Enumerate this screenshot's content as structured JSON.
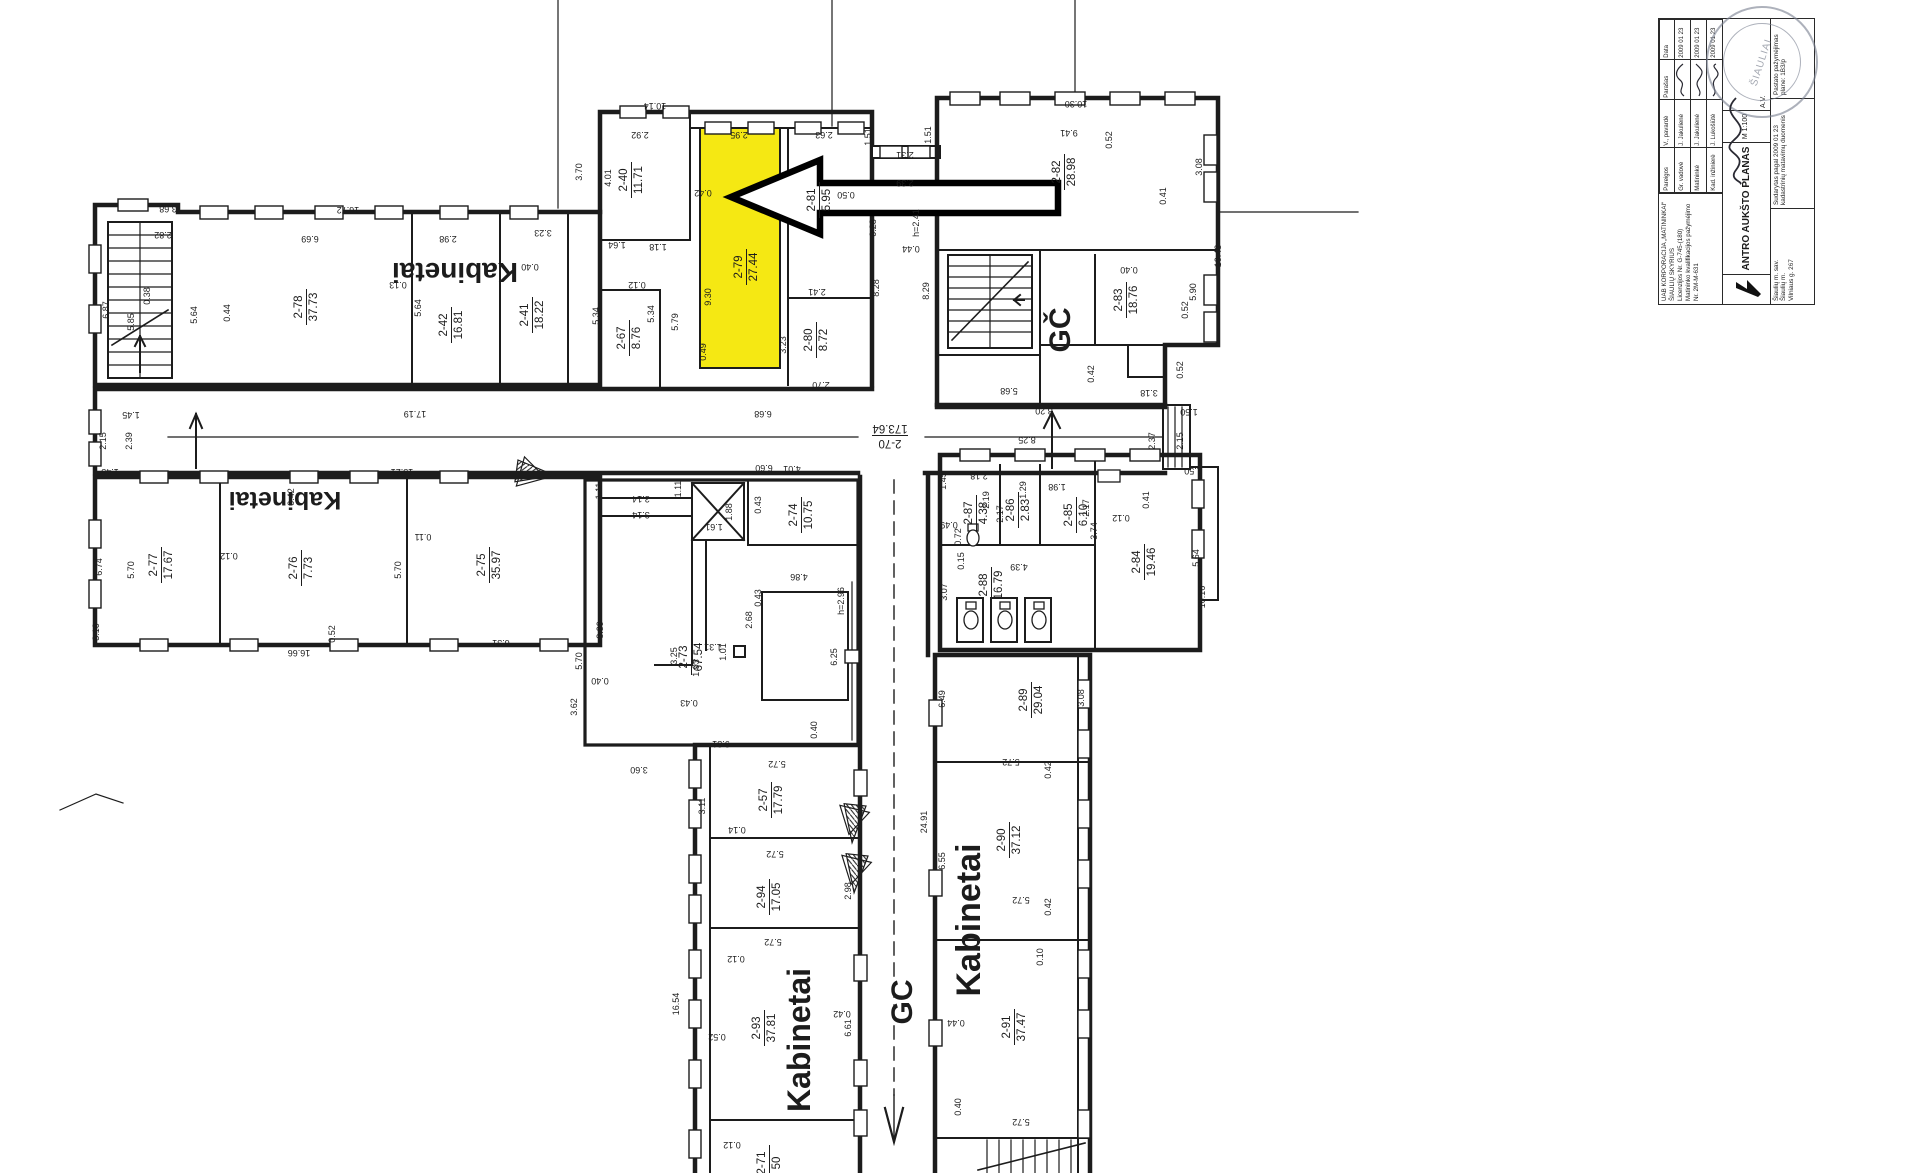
{
  "colors": {
    "highlight": "#f5e813",
    "line": "#1c1c1c",
    "stamp": "#7b8292"
  },
  "plan": {
    "rooms": [
      {
        "id": "2-78",
        "area": "37.73",
        "x": 305,
        "y": 307,
        "rot": -90
      },
      {
        "id": "2-42",
        "area": "16.81",
        "x": 450,
        "y": 325,
        "rot": -90
      },
      {
        "id": "2-41",
        "area": "18.22",
        "x": 531,
        "y": 315,
        "rot": -90
      },
      {
        "id": "2-40",
        "area": "11.71",
        "x": 630,
        "y": 180,
        "rot": -90
      },
      {
        "id": "2-67",
        "area": "8.76",
        "x": 628,
        "y": 338,
        "rot": -90
      },
      {
        "id": "2-79",
        "area": "27.44",
        "x": 745,
        "y": 267,
        "rot": -90
      },
      {
        "id": "2-81",
        "area": "5.95",
        "x": 818,
        "y": 200,
        "rot": -90
      },
      {
        "id": "2-80",
        "area": "8.72",
        "x": 815,
        "y": 340,
        "rot": -90
      },
      {
        "id": "2-82",
        "area": "28.98",
        "x": 1063,
        "y": 172,
        "rot": -90
      },
      {
        "id": "2-83",
        "area": "18.76",
        "x": 1125,
        "y": 300,
        "rot": -90
      },
      {
        "id": "2-70",
        "area": "173.64",
        "x": 890,
        "y": 437,
        "rot": 180
      },
      {
        "id": "2-77",
        "area": "17.67",
        "x": 160,
        "y": 565,
        "rot": -90
      },
      {
        "id": "2-76",
        "area": "7.73",
        "x": 300,
        "y": 568,
        "rot": -90
      },
      {
        "id": "2-75",
        "area": "35.97",
        "x": 488,
        "y": 565,
        "rot": -90
      },
      {
        "id": "2-73",
        "area": "67.54",
        "x": 690,
        "y": 657,
        "rot": -90
      },
      {
        "id": "2-74",
        "area": "10.75",
        "x": 800,
        "y": 515,
        "rot": -90
      },
      {
        "id": "2-87",
        "area": "4.38",
        "x": 975,
        "y": 513,
        "rot": -90
      },
      {
        "id": "2-86",
        "area": "2.83",
        "x": 1017,
        "y": 510,
        "rot": -90
      },
      {
        "id": "2-85",
        "area": "6.10",
        "x": 1075,
        "y": 515,
        "rot": -90
      },
      {
        "id": "2-88",
        "area": "16.79",
        "x": 990,
        "y": 585,
        "rot": -90
      },
      {
        "id": "2-84",
        "area": "19.46",
        "x": 1143,
        "y": 562,
        "rot": -90
      },
      {
        "id": "2-57",
        "area": "17.79",
        "x": 770,
        "y": 800,
        "rot": -90
      },
      {
        "id": "2-94",
        "area": "17.05",
        "x": 768,
        "y": 897,
        "rot": -90
      },
      {
        "id": "2-93",
        "area": "37.81",
        "x": 763,
        "y": 1028,
        "rot": -90
      },
      {
        "id": "2-89",
        "area": "29.04",
        "x": 1030,
        "y": 700,
        "rot": -90
      },
      {
        "id": "2-90",
        "area": "37.12",
        "x": 1008,
        "y": 840,
        "rot": -90
      },
      {
        "id": "2-91",
        "area": "37.47",
        "x": 1013,
        "y": 1027,
        "rot": -90
      },
      {
        "id": "2-71",
        "area": "50",
        "x": 768,
        "y": 1163,
        "rot": -90
      }
    ],
    "big_labels": [
      {
        "t": "Kabinetai",
        "x": 455,
        "y": 263,
        "rot": 180,
        "s": 28
      },
      {
        "t": "Kabinetai",
        "x": 285,
        "y": 492,
        "rot": 180,
        "s": 25
      },
      {
        "t": "Kabinetai",
        "x": 810,
        "y": 1040,
        "rot": -90,
        "s": 32
      },
      {
        "t": "Kabinetai",
        "x": 980,
        "y": 920,
        "rot": -90,
        "s": 34
      },
      {
        "t": "GČ",
        "x": 1070,
        "y": 330,
        "rot": -90,
        "s": 30
      },
      {
        "t": "GC",
        "x": 912,
        "y": 1002,
        "rot": -90,
        "s": 30
      }
    ],
    "dims": [
      {
        "t": "3.68",
        "x": 168,
        "y": 206,
        "r": 180
      },
      {
        "t": "2.82",
        "x": 163,
        "y": 232,
        "r": 180
      },
      {
        "t": "16.72",
        "x": 348,
        "y": 207,
        "r": 180
      },
      {
        "t": "6.69",
        "x": 310,
        "y": 236,
        "r": 180
      },
      {
        "t": "2.98",
        "x": 448,
        "y": 236,
        "r": 180
      },
      {
        "t": "0.13",
        "x": 398,
        "y": 282,
        "r": 180
      },
      {
        "t": "6.87",
        "x": 109,
        "y": 310,
        "r": -90
      },
      {
        "t": "5.85",
        "x": 134,
        "y": 322,
        "r": -90
      },
      {
        "t": "5.64",
        "x": 197,
        "y": 315,
        "r": -90
      },
      {
        "t": "0.44",
        "x": 230,
        "y": 313,
        "r": -90
      },
      {
        "t": "5.64",
        "x": 421,
        "y": 308,
        "r": -90
      },
      {
        "t": "3.23",
        "x": 543,
        "y": 230,
        "r": 180
      },
      {
        "t": "0.38",
        "x": 150,
        "y": 296,
        "r": -90
      },
      {
        "t": "1.45",
        "x": 131,
        "y": 412,
        "r": 180
      },
      {
        "t": "2.15",
        "x": 106,
        "y": 441,
        "r": -90
      },
      {
        "t": "2.39",
        "x": 132,
        "y": 441,
        "r": -90
      },
      {
        "t": "1.45",
        "x": 110,
        "y": 469,
        "r": 180
      },
      {
        "t": "17.19",
        "x": 415,
        "y": 411,
        "r": 180
      },
      {
        "t": "15.21",
        "x": 402,
        "y": 469,
        "r": 180
      },
      {
        "t": "10.14",
        "x": 655,
        "y": 103,
        "r": 180
      },
      {
        "t": "3.70",
        "x": 582,
        "y": 172,
        "r": -90
      },
      {
        "t": "2.92",
        "x": 640,
        "y": 132,
        "r": 180
      },
      {
        "t": "4.01",
        "x": 611,
        "y": 178,
        "r": -90
      },
      {
        "t": "0.40",
        "x": 530,
        "y": 264,
        "r": 180
      },
      {
        "t": "1.64",
        "x": 617,
        "y": 242,
        "r": 180
      },
      {
        "t": "1.18",
        "x": 658,
        "y": 244,
        "r": 180
      },
      {
        "t": "0.12",
        "x": 637,
        "y": 282,
        "r": 180
      },
      {
        "t": "5.34",
        "x": 599,
        "y": 316,
        "r": -90
      },
      {
        "t": "5.34",
        "x": 654,
        "y": 314,
        "r": -90
      },
      {
        "t": "5.79",
        "x": 678,
        "y": 322,
        "r": -90
      },
      {
        "t": "2.95",
        "x": 739,
        "y": 132,
        "r": 180
      },
      {
        "t": "0.42",
        "x": 703,
        "y": 190,
        "r": 180
      },
      {
        "t": "9.30",
        "x": 711,
        "y": 297,
        "r": -90
      },
      {
        "t": "0.49",
        "x": 706,
        "y": 352,
        "r": -90
      },
      {
        "t": "2.63",
        "x": 824,
        "y": 132,
        "r": 180
      },
      {
        "t": "0.50",
        "x": 846,
        "y": 192,
        "r": 180
      },
      {
        "t": "2.41",
        "x": 817,
        "y": 289,
        "r": 180
      },
      {
        "t": "3.23",
        "x": 786,
        "y": 345,
        "r": -90
      },
      {
        "t": "2.70",
        "x": 821,
        "y": 382,
        "r": 180
      },
      {
        "t": "0.28",
        "x": 876,
        "y": 228,
        "r": -90
      },
      {
        "t": "8.28",
        "x": 879,
        "y": 288,
        "r": -90
      },
      {
        "t": "8.29",
        "x": 929,
        "y": 291,
        "r": -90
      },
      {
        "t": "2.31",
        "x": 905,
        "y": 152,
        "r": 180
      },
      {
        "t": "2.39",
        "x": 905,
        "y": 180,
        "r": 180
      },
      {
        "t": "1.51",
        "x": 871,
        "y": 137,
        "r": -90
      },
      {
        "t": "1.51",
        "x": 931,
        "y": 135,
        "r": -90
      },
      {
        "t": "h=2.41",
        "x": 919,
        "y": 223,
        "r": -90
      },
      {
        "t": "0.44",
        "x": 911,
        "y": 246,
        "r": 180
      },
      {
        "t": "10.30",
        "x": 1076,
        "y": 101,
        "r": 180
      },
      {
        "t": "9.41",
        "x": 1069,
        "y": 130,
        "r": 180
      },
      {
        "t": "0.52",
        "x": 1112,
        "y": 140,
        "r": -90
      },
      {
        "t": "0.41",
        "x": 1166,
        "y": 196,
        "r": -90
      },
      {
        "t": "3.08",
        "x": 1202,
        "y": 167,
        "r": -90
      },
      {
        "t": "0.40",
        "x": 1129,
        "y": 267,
        "r": 180
      },
      {
        "t": "5.90",
        "x": 1196,
        "y": 292,
        "r": -90
      },
      {
        "t": "0.52",
        "x": 1188,
        "y": 310,
        "r": -90
      },
      {
        "t": "5.68",
        "x": 1009,
        "y": 388,
        "r": 180
      },
      {
        "t": "0.42",
        "x": 1094,
        "y": 374,
        "r": -90
      },
      {
        "t": "3.18",
        "x": 1149,
        "y": 390,
        "r": 180
      },
      {
        "t": "0.52",
        "x": 1183,
        "y": 370,
        "r": -90
      },
      {
        "t": "10.43",
        "x": 1221,
        "y": 256,
        "r": -90
      },
      {
        "t": "8.20",
        "x": 1044,
        "y": 408,
        "r": 180
      },
      {
        "t": "8.25",
        "x": 1027,
        "y": 437,
        "r": 180
      },
      {
        "t": "2.37",
        "x": 1155,
        "y": 441,
        "r": -90
      },
      {
        "t": "2.15",
        "x": 1183,
        "y": 441,
        "r": -90
      },
      {
        "t": "1.50",
        "x": 1189,
        "y": 409,
        "r": 180
      },
      {
        "t": "1.50",
        "x": 1193,
        "y": 468,
        "r": 180
      },
      {
        "t": "6.68",
        "x": 763,
        "y": 411,
        "r": 180
      },
      {
        "t": "6.60",
        "x": 764,
        "y": 465,
        "r": 180
      },
      {
        "t": "4.01",
        "x": 792,
        "y": 466,
        "r": 180
      },
      {
        "t": "0.43",
        "x": 761,
        "y": 505,
        "r": -90
      },
      {
        "t": "0.42",
        "x": 294,
        "y": 497,
        "r": -90
      },
      {
        "t": "0.11",
        "x": 423,
        "y": 534,
        "r": 180
      },
      {
        "t": "6.74",
        "x": 102,
        "y": 567,
        "r": -90
      },
      {
        "t": "5.70",
        "x": 134,
        "y": 570,
        "r": -90
      },
      {
        "t": "0.12",
        "x": 229,
        "y": 553,
        "r": 180
      },
      {
        "t": "5.70",
        "x": 401,
        "y": 570,
        "r": -90
      },
      {
        "t": "3.10",
        "x": 99,
        "y": 632,
        "r": -90
      },
      {
        "t": "0.52",
        "x": 335,
        "y": 634,
        "r": -90
      },
      {
        "t": "16.66",
        "x": 299,
        "y": 650,
        "r": 180
      },
      {
        "t": "6.31",
        "x": 501,
        "y": 640,
        "r": 180
      },
      {
        "t": "3.14",
        "x": 641,
        "y": 496,
        "r": 180
      },
      {
        "t": "3.14",
        "x": 641,
        "y": 512,
        "r": 180
      },
      {
        "t": "1.11",
        "x": 602,
        "y": 491,
        "r": -90
      },
      {
        "t": "1.11",
        "x": 681,
        "y": 489,
        "r": -90
      },
      {
        "t": "1.88",
        "x": 732,
        "y": 512,
        "r": -90
      },
      {
        "t": "1.61",
        "x": 714,
        "y": 524,
        "r": 180
      },
      {
        "t": "3.25",
        "x": 677,
        "y": 656,
        "r": -90
      },
      {
        "t": "1.93",
        "x": 699,
        "y": 668,
        "r": -90
      },
      {
        "t": "1.31",
        "x": 713,
        "y": 644,
        "r": 180
      },
      {
        "t": "1.01",
        "x": 726,
        "y": 652,
        "r": -90
      },
      {
        "t": "0.43",
        "x": 689,
        "y": 700,
        "r": 180
      },
      {
        "t": "2.68",
        "x": 752,
        "y": 620,
        "r": -90
      },
      {
        "t": "0.43",
        "x": 761,
        "y": 598,
        "r": -90
      },
      {
        "t": "5.70",
        "x": 582,
        "y": 661,
        "r": -90
      },
      {
        "t": "0.40",
        "x": 600,
        "y": 678,
        "r": 180
      },
      {
        "t": "8.39",
        "x": 603,
        "y": 630,
        "r": -90
      },
      {
        "t": "3.62",
        "x": 577,
        "y": 707,
        "r": -90
      },
      {
        "t": "3.60",
        "x": 639,
        "y": 767,
        "r": 180
      },
      {
        "t": "9.31",
        "x": 721,
        "y": 741,
        "r": 180
      },
      {
        "t": "0.40",
        "x": 817,
        "y": 730,
        "r": -90
      },
      {
        "t": "4.86",
        "x": 799,
        "y": 574,
        "r": 180
      },
      {
        "t": "h=2.96",
        "x": 844,
        "y": 601,
        "r": -90
      },
      {
        "t": "6.25",
        "x": 837,
        "y": 657,
        "r": -90
      },
      {
        "t": "1.45",
        "x": 946,
        "y": 481,
        "r": -90
      },
      {
        "t": "2.18",
        "x": 979,
        "y": 473,
        "r": 180
      },
      {
        "t": "0.49",
        "x": 949,
        "y": 522,
        "r": 180
      },
      {
        "t": "0.72",
        "x": 961,
        "y": 537,
        "r": -90
      },
      {
        "t": "2.19",
        "x": 989,
        "y": 500,
        "r": -90
      },
      {
        "t": "2.17",
        "x": 1003,
        "y": 514,
        "r": -90
      },
      {
        "t": "1.29",
        "x": 1026,
        "y": 490,
        "r": -90
      },
      {
        "t": "2.17",
        "x": 1089,
        "y": 508,
        "r": -90
      },
      {
        "t": "1.98",
        "x": 1057,
        "y": 484,
        "r": 180
      },
      {
        "t": "0.15",
        "x": 964,
        "y": 561,
        "r": -90
      },
      {
        "t": "3.07",
        "x": 947,
        "y": 592,
        "r": -90
      },
      {
        "t": "4.39",
        "x": 1019,
        "y": 564,
        "r": 180
      },
      {
        "t": "3.74",
        "x": 1097,
        "y": 531,
        "r": -90
      },
      {
        "t": "0.41",
        "x": 1149,
        "y": 500,
        "r": -90
      },
      {
        "t": "0.12",
        "x": 1121,
        "y": 515,
        "r": 180
      },
      {
        "t": "5.64",
        "x": 1199,
        "y": 558,
        "r": -90
      },
      {
        "t": "10.16",
        "x": 1205,
        "y": 597,
        "r": -90
      },
      {
        "t": "5.72",
        "x": 777,
        "y": 761,
        "r": 180
      },
      {
        "t": "3.11",
        "x": 705,
        "y": 806,
        "r": -90
      },
      {
        "t": "0.14",
        "x": 737,
        "y": 827,
        "r": 180
      },
      {
        "t": "5.72",
        "x": 775,
        "y": 851,
        "r": 180
      },
      {
        "t": "5.72",
        "x": 773,
        "y": 939,
        "r": 180
      },
      {
        "t": "0.12",
        "x": 736,
        "y": 956,
        "r": 180
      },
      {
        "t": "16.54",
        "x": 679,
        "y": 1004,
        "r": -90
      },
      {
        "t": "0.52",
        "x": 717,
        "y": 1034,
        "r": 180
      },
      {
        "t": "0.42",
        "x": 842,
        "y": 1011,
        "r": 180
      },
      {
        "t": "6.61",
        "x": 851,
        "y": 1028,
        "r": -90
      },
      {
        "t": "0.12",
        "x": 732,
        "y": 1142,
        "r": 180
      },
      {
        "t": "2.98",
        "x": 851,
        "y": 891,
        "r": -90
      },
      {
        "t": "24.91",
        "x": 927,
        "y": 822,
        "r": -90
      },
      {
        "t": "6.49",
        "x": 945,
        "y": 699,
        "r": -90
      },
      {
        "t": "5.72",
        "x": 1011,
        "y": 759,
        "r": 180
      },
      {
        "t": "0.42",
        "x": 1051,
        "y": 770,
        "r": -90
      },
      {
        "t": "6.55",
        "x": 945,
        "y": 861,
        "r": -90
      },
      {
        "t": "5.72",
        "x": 1021,
        "y": 897,
        "r": 180
      },
      {
        "t": "0.42",
        "x": 1051,
        "y": 907,
        "r": -90
      },
      {
        "t": "0.10",
        "x": 1043,
        "y": 957,
        "r": -90
      },
      {
        "t": "0.44",
        "x": 956,
        "y": 1020,
        "r": 180
      },
      {
        "t": "0.40",
        "x": 961,
        "y": 1107,
        "r": -90
      },
      {
        "t": "5.72",
        "x": 1021,
        "y": 1119,
        "r": 180
      },
      {
        "t": "3.08",
        "x": 1084,
        "y": 698,
        "r": -90
      }
    ]
  },
  "title_block": {
    "company": [
      "UAB KORPORACIJA „MATININKAI“",
      "ŠIAULIŲ SKYRIUS",
      "Licenzijos Nr. G-745-(180)",
      "Matininko kvalifikacijos pažymėjimo Nr. 2M-M-631"
    ],
    "table": {
      "headers": [
        "Pareigos",
        "V., pavardė",
        "Parašas",
        "Data"
      ],
      "rows": [
        [
          "Gr. vadovė",
          "J. Jakulienė",
          "2009 01 23"
        ],
        [
          "Matininkė",
          "J. Jakulienė",
          "2009 01 23"
        ],
        [
          "Kad. inžinierė",
          "J. Lukošiūtė",
          "2009 01 23"
        ]
      ]
    },
    "drawing_title": "ANTRO AUKŠTO PLANAS",
    "scale": "M 1:100",
    "stamp_note": "A.V.",
    "stamp_text": "ŠIAULIAI",
    "address": [
      "Šiaulių m. sav.",
      "Šiaulių m.",
      "Vilniaus g. 267"
    ],
    "basis": [
      "Sudarytas pagal 2009 01 23",
      "kadastrinių matavimų duomenis"
    ],
    "note": [
      "Pastato pažymėjimas",
      "plane: 1B3/p"
    ]
  }
}
